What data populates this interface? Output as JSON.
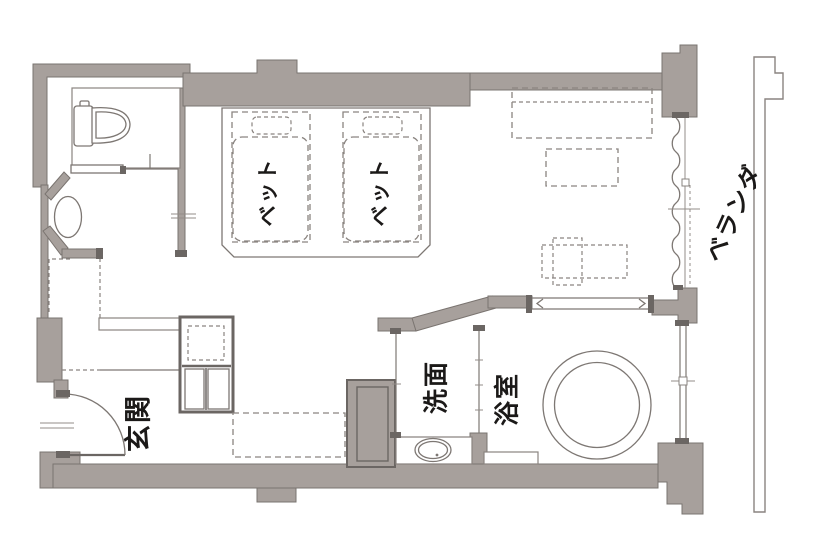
{
  "floor_plan": {
    "labels": {
      "bed_left": "ベット",
      "bed_right": "ベット",
      "entrance": "玄関",
      "washroom": "洗面",
      "bathroom": "浴室",
      "veranda": "ベランダ"
    },
    "colors": {
      "wall": "#a7a09c",
      "wall_outline": "#7a7470",
      "line": "#8a8480",
      "dark_accent": "#6b6663",
      "text": "#1b1918",
      "background": "#ffffff"
    },
    "symbols": [
      "toilet",
      "wash-basin",
      "sliding-door",
      "entrance-door-swing",
      "closet",
      "luggage-space",
      "twin-beds",
      "sofa",
      "table",
      "chair",
      "curtain-window",
      "vanity-sink",
      "round-bathtub",
      "bath-window",
      "veranda-rail"
    ]
  }
}
